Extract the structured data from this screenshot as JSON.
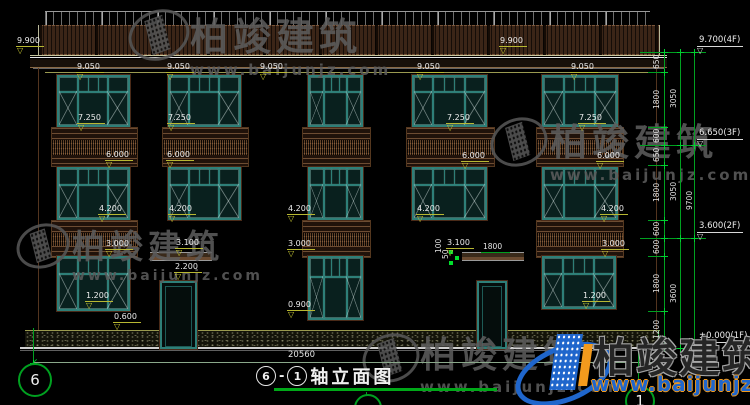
{
  "watermark": {
    "brand": "柏竣建筑",
    "url": "www.baijunjz.com"
  },
  "logo": {
    "brand": "柏竣建筑",
    "url": "www.baijunjz.com"
  },
  "title": {
    "a": "6",
    "dash": "-",
    "b": "1",
    "text": "轴立面图"
  },
  "bottom": {
    "overall_width": "20560",
    "axis_left": "6",
    "axis_right": "1"
  },
  "drawing": {
    "elev_labels": [
      {
        "v": "9.900",
        "x": 16,
        "y": 36
      },
      {
        "v": "9.900",
        "x": 499,
        "y": 36
      },
      {
        "v": "9.050",
        "x": 76,
        "y": 62
      },
      {
        "v": "9.050",
        "x": 166,
        "y": 62
      },
      {
        "v": "9.050",
        "x": 259,
        "y": 62
      },
      {
        "v": "9.050",
        "x": 416,
        "y": 62
      },
      {
        "v": "9.050",
        "x": 570,
        "y": 62
      },
      {
        "v": "7.250",
        "x": 77,
        "y": 113
      },
      {
        "v": "7.250",
        "x": 167,
        "y": 113
      },
      {
        "v": "7.250",
        "x": 446,
        "y": 113
      },
      {
        "v": "7.250",
        "x": 578,
        "y": 113
      },
      {
        "v": "6.000",
        "x": 105,
        "y": 150
      },
      {
        "v": "6.000",
        "x": 166,
        "y": 150
      },
      {
        "v": "6.000",
        "x": 461,
        "y": 151
      },
      {
        "v": "6.000",
        "x": 596,
        "y": 151
      },
      {
        "v": "4.200",
        "x": 98,
        "y": 204
      },
      {
        "v": "4.200",
        "x": 168,
        "y": 204
      },
      {
        "v": "4.200",
        "x": 287,
        "y": 204
      },
      {
        "v": "4.200",
        "x": 416,
        "y": 204
      },
      {
        "v": "4.200",
        "x": 600,
        "y": 204
      },
      {
        "v": "3.000",
        "x": 105,
        "y": 239
      },
      {
        "v": "3.000",
        "x": 287,
        "y": 239
      },
      {
        "v": "3.000",
        "x": 601,
        "y": 239
      },
      {
        "v": "3.100",
        "x": 175,
        "y": 238
      },
      {
        "v": "3.100",
        "x": 446,
        "y": 238
      },
      {
        "v": "2.200",
        "x": 174,
        "y": 262
      },
      {
        "v": "1.200",
        "x": 85,
        "y": 291
      },
      {
        "v": "1.200",
        "x": 582,
        "y": 291
      },
      {
        "v": "0.900",
        "x": 287,
        "y": 300
      },
      {
        "v": "0.600",
        "x": 113,
        "y": 312
      }
    ],
    "lin_dims": [
      {
        "v": "1800",
        "x": 481,
        "y": 243
      }
    ],
    "small_dims": [
      {
        "v": "100",
        "x": 433,
        "y": 240
      },
      {
        "v": "50",
        "x": 440,
        "y": 248
      }
    ],
    "right_chain": {
      "ticks": [
        52,
        72,
        127,
        145,
        165,
        220,
        238,
        256,
        311,
        348
      ],
      "segments": [
        {
          "v": "650",
          "y1": 52,
          "y2": 72
        },
        {
          "v": "1800",
          "y1": 72,
          "y2": 127
        },
        {
          "v": "600",
          "y1": 127,
          "y2": 145
        },
        {
          "v": "650",
          "y1": 145,
          "y2": 165
        },
        {
          "v": "1800",
          "y1": 165,
          "y2": 220
        },
        {
          "v": "600",
          "y1": 220,
          "y2": 238
        },
        {
          "v": "600",
          "y1": 238,
          "y2": 256
        },
        {
          "v": "1800",
          "y1": 256,
          "y2": 311
        },
        {
          "v": "1200",
          "y1": 311,
          "y2": 348
        }
      ],
      "subtotals": [
        {
          "v": "3050",
          "y1": 52,
          "y2": 145
        },
        {
          "v": "3050",
          "y1": 145,
          "y2": 238
        },
        {
          "v": "3600",
          "y1": 238,
          "y2": 348
        }
      ],
      "total": {
        "v": "9700",
        "y1": 52,
        "y2": 348
      },
      "levels": [
        {
          "label": "9.700(4F)",
          "y": 52
        },
        {
          "label": "6.650(3F)",
          "y": 145
        },
        {
          "label": "3.600(2F)",
          "y": 238
        },
        {
          "label": "±0.000(1F)",
          "y": 348
        }
      ]
    },
    "windows": [
      [
        57,
        75,
        73,
        52
      ],
      [
        168,
        75,
        73,
        52
      ],
      [
        308,
        75,
        55,
        52
      ],
      [
        412,
        75,
        75,
        52
      ],
      [
        542,
        75,
        76,
        52
      ],
      [
        57,
        167,
        73,
        53
      ],
      [
        168,
        167,
        73,
        53
      ],
      [
        308,
        167,
        55,
        53
      ],
      [
        412,
        167,
        75,
        53
      ],
      [
        542,
        167,
        76,
        53
      ],
      [
        57,
        256,
        73,
        55
      ],
      [
        308,
        256,
        55,
        64
      ],
      [
        542,
        256,
        74,
        53
      ]
    ],
    "doors": [
      [
        160,
        281,
        37,
        64
      ],
      [
        477,
        281,
        30,
        64
      ]
    ],
    "bands": [
      [
        51,
        127,
        85,
        38
      ],
      [
        162,
        127,
        85,
        38
      ],
      [
        302,
        127,
        67,
        38
      ],
      [
        406,
        127,
        87,
        38
      ],
      [
        536,
        127,
        86,
        38
      ],
      [
        51,
        220,
        85,
        36
      ],
      [
        302,
        220,
        67,
        36
      ],
      [
        536,
        220,
        86,
        36
      ]
    ],
    "canopies": [
      [
        150,
        252,
        62
      ],
      [
        462,
        252,
        62
      ]
    ],
    "axis_bubbles": [
      {
        "n": "6",
        "x": 18,
        "y": 363,
        "d": 30
      },
      {
        "n": "1",
        "x": 625,
        "y": 386,
        "d": 26
      },
      {
        "n": "",
        "x": 354,
        "y": 394,
        "d": 24
      }
    ],
    "axis_lines": [
      [
        33,
        328,
        35
      ],
      [
        638,
        352,
        34
      ],
      [
        366,
        392,
        13
      ],
      [
        658,
        330,
        33
      ]
    ]
  }
}
